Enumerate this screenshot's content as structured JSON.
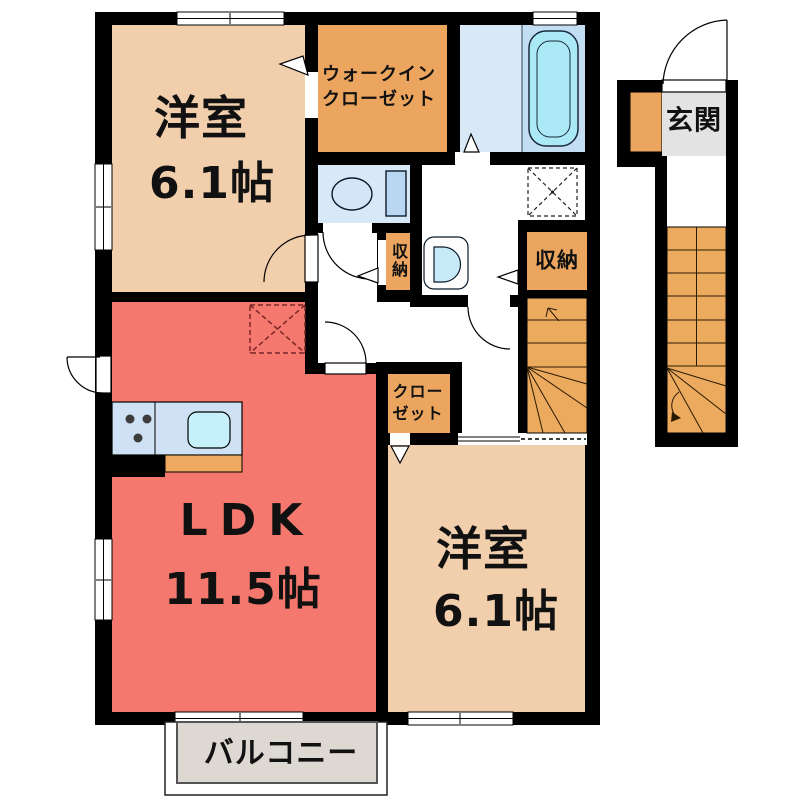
{
  "rooms": {
    "bedroom_top": {
      "name": "洋室",
      "area": "6.1帖"
    },
    "walk_in_closet": {
      "line1": "ウォークイン",
      "line2": "クローゼット"
    },
    "entrance": {
      "name": "玄関"
    },
    "storage_left": {
      "name": "収納"
    },
    "storage_right": {
      "name": "収納"
    },
    "closet": {
      "line1": "クロー",
      "line2": "ゼット"
    },
    "ldk": {
      "name": "LDK",
      "area": "11.5帖"
    },
    "bedroom_bottom": {
      "name": "洋室",
      "area": "6.1帖"
    },
    "balcony": {
      "name": "バルコニー"
    }
  },
  "colors": {
    "wall": "#000000",
    "bedroom_beige": "#f2cfac",
    "accent_orange": "#eca55e",
    "stairs_orange": "#ecaa5f",
    "ldk_red": "#f5786e",
    "water_blue": "#d9e8f7",
    "bath_panel_blue": "#c3ddf3",
    "bathtub_cyan": "#ace9f7",
    "sink_cyan": "#c6f0fa",
    "counter_blue": "#cfe2f5",
    "genkan_gray": "#e3e3e3",
    "balcony_gray": "#ded8d2",
    "hood_mark_red": "#7a2525"
  },
  "fixtures": [
    "bathtub",
    "toilet",
    "washbasin",
    "kitchen-counter",
    "kitchen-sink",
    "stove-burners",
    "washing-machine-space",
    "range-hood-mark",
    "internal-staircase",
    "external-staircase",
    "shoe-cabinet",
    "entrance-door",
    "balcony"
  ]
}
